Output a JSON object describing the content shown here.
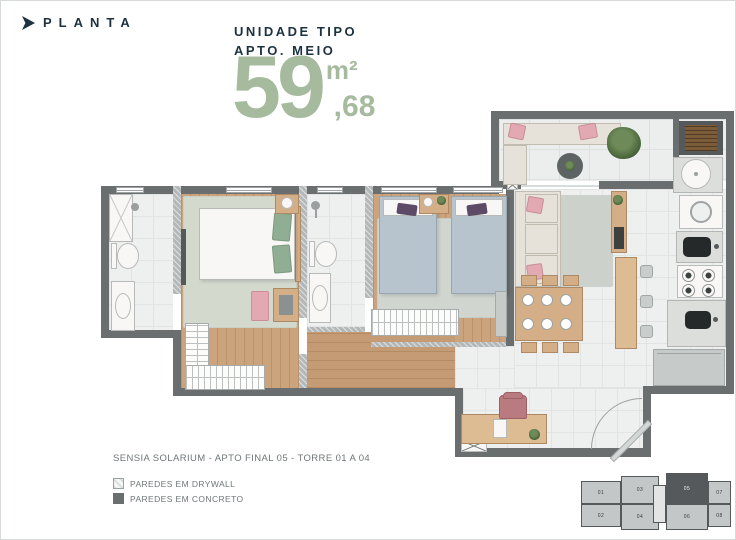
{
  "header": {
    "title": "PLANTA"
  },
  "unit_info": {
    "line1": "UNIDADE TIPO",
    "line2": "APTO. MEIO",
    "area_int": "59",
    "area_unit": "m²",
    "area_dec": ",68"
  },
  "caption": "SENSIA SOLARIUM - APTO FINAL 05 - TORRE 01 A 04",
  "legend": {
    "items": [
      {
        "label": "PAREDES EM DRYWALL",
        "type": "drywall"
      },
      {
        "label": "PAREDES EM CONCRETO",
        "type": "concrete"
      }
    ]
  },
  "keyplan": {
    "units": [
      {
        "label": "01",
        "highlight": false
      },
      {
        "label": "02",
        "highlight": false
      },
      {
        "label": "03",
        "highlight": false
      },
      {
        "label": "04",
        "highlight": false
      },
      {
        "label": "05",
        "highlight": true
      },
      {
        "label": "06",
        "highlight": false
      },
      {
        "label": "07",
        "highlight": false
      },
      {
        "label": "08",
        "highlight": false
      }
    ]
  },
  "icons": {
    "brand-bullet": "right-arrow",
    "column-marker": "x-cross",
    "door-swing": "quarter-arc"
  },
  "colors": {
    "accent_green": "#a6ba9e",
    "navy": "#1c3240",
    "text_gray": "#707678",
    "wall_concrete": "#6a6e6f",
    "wall_drywall": "#b4b8b9",
    "wood_floor": "#cba47e",
    "highlighted_unit": "#55595b"
  }
}
